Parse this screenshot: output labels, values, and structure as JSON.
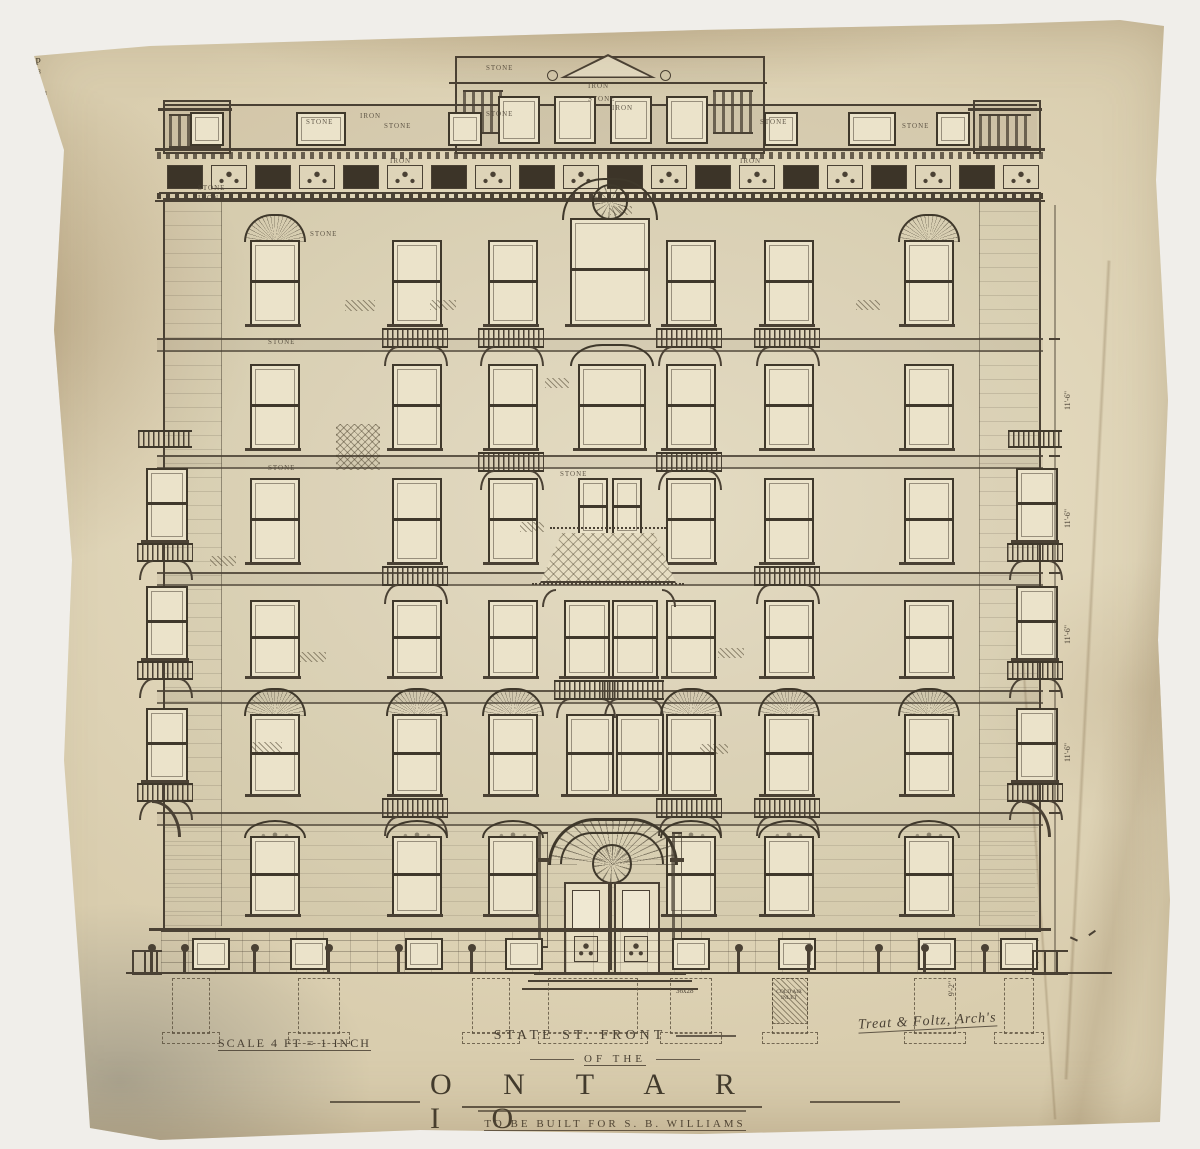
{
  "title_block": {
    "line1": "STATE ST. FRONT",
    "line2": "OF THE",
    "building_name": "O N T A R I O",
    "commission": "TO BE BUILT FOR   S. B. WILLIAMS",
    "date": "1880",
    "scale_note": "SCALE 4 FT = 1 INCH",
    "architect": "Treat & Foltz, Arch's"
  },
  "facade": {
    "ink": "#4a4134",
    "material_labels": [
      {
        "t": "STONE",
        "x": 486,
        "y": 64
      },
      {
        "t": "IRON",
        "x": 588,
        "y": 82
      },
      {
        "t": "STONE",
        "x": 588,
        "y": 95
      },
      {
        "t": "STONE",
        "x": 486,
        "y": 110
      },
      {
        "t": "STONE",
        "x": 306,
        "y": 118
      },
      {
        "t": "IRON",
        "x": 360,
        "y": 112
      },
      {
        "t": "STONE",
        "x": 384,
        "y": 122
      },
      {
        "t": "STONE",
        "x": 198,
        "y": 184
      },
      {
        "t": "IRON",
        "x": 198,
        "y": 194
      },
      {
        "t": "IRON",
        "x": 612,
        "y": 104
      },
      {
        "t": "STONE",
        "x": 760,
        "y": 118
      },
      {
        "t": "STONE",
        "x": 902,
        "y": 122
      },
      {
        "t": "STONE",
        "x": 310,
        "y": 230
      },
      {
        "t": "STONE",
        "x": 268,
        "y": 338
      },
      {
        "t": "STONE",
        "x": 268,
        "y": 464
      },
      {
        "t": "STONE",
        "x": 560,
        "y": 470
      },
      {
        "t": "IRON",
        "x": 740,
        "y": 157
      },
      {
        "t": "IRON",
        "x": 390,
        "y": 157
      }
    ],
    "parapet": {
      "x": 455,
      "y": 56,
      "w": 306,
      "h": 94,
      "windows": [
        {
          "x": 498,
          "mk": "D.T.",
          "db": "36x20"
        },
        {
          "x": 554,
          "mk": "D.T.",
          "db": "18x20"
        },
        {
          "x": 610,
          "mk": "D.T.",
          "db": "18x20"
        },
        {
          "x": 666,
          "mk": "D.T.",
          "db": "36x20"
        }
      ]
    },
    "attic_windows": [
      {
        "x": 190,
        "w": 30,
        "db": "36x16"
      },
      {
        "x": 296,
        "w": 46,
        "db": "32x16 D.T."
      },
      {
        "x": 448,
        "w": 30,
        "db": "26x16"
      },
      {
        "x": 764,
        "w": 30,
        "db": "30x16"
      },
      {
        "x": 848,
        "w": 44,
        "db": "D.T."
      },
      {
        "x": 936,
        "w": 30,
        "db": "32x16"
      }
    ],
    "belts": [
      338,
      455,
      572,
      690,
      812
    ],
    "rows": [
      {
        "y": 240,
        "h": 82,
        "windows": [
          {
            "x": 250,
            "w": 46,
            "hood": "arch",
            "dt": "36x32",
            "mk": "P",
            "db": "36x32"
          },
          {
            "x": 392,
            "w": 46,
            "dt": "36x28",
            "mk": "P",
            "db": "36x28",
            "bal": true
          },
          {
            "x": 488,
            "w": 46,
            "dt": "36x32",
            "mk": "P",
            "db": "36x32",
            "bal": true
          },
          {
            "x": 570,
            "w": 76,
            "y": 218,
            "h": 104,
            "hood": "trac",
            "dt": "",
            "mk": "P",
            "db": "18+24"
          },
          {
            "x": 666,
            "w": 46,
            "dt": "46x28",
            "mk": "P",
            "db": "40x28",
            "bal": true
          },
          {
            "x": 764,
            "w": 46,
            "dt": "40x28",
            "mk": "P",
            "db": "40x28",
            "bal": true
          },
          {
            "x": 904,
            "w": 46,
            "hood": "arch",
            "dt": "32x28",
            "mk": "P",
            "db": "32x28"
          }
        ]
      },
      {
        "y": 364,
        "h": 82,
        "windows": [
          {
            "x": 250,
            "w": 46,
            "dt": "33x38",
            "mk": "P",
            "db": "33x38"
          },
          {
            "x": 392,
            "w": 46,
            "dt": "40x38",
            "mk": "P",
            "db": "40x38"
          },
          {
            "x": 488,
            "w": 46,
            "dt": "40x38",
            "mk": "P",
            "db": "40x38",
            "bal": true
          },
          {
            "x": 578,
            "w": 64,
            "hood": "ogee",
            "dt": "44x38",
            "mk": "P",
            "db": "44x38"
          },
          {
            "x": 666,
            "w": 46,
            "dt": "36x38",
            "mk": "P",
            "db": "36x38",
            "bal": true
          },
          {
            "x": 764,
            "w": 46,
            "dt": "40x38",
            "mk": "P",
            "db": "40x38"
          },
          {
            "x": 904,
            "w": 46,
            "dt": "32x38",
            "mk": "P",
            "db": "32x38"
          }
        ]
      },
      {
        "y": 478,
        "h": 82,
        "windows": [
          {
            "x": 250,
            "w": 46,
            "dt": "32x42",
            "mk": "P",
            "db": "32x42"
          },
          {
            "x": 392,
            "w": 46,
            "dt": "40x42",
            "mk": "P",
            "db": "40x42",
            "bal": true
          },
          {
            "x": 488,
            "w": 46,
            "dt": "40x42",
            "mk": "P",
            "db": "40x42"
          },
          {
            "x": 578,
            "w": 26,
            "h": 54,
            "dt": "18+26",
            "mk": "",
            "db": ""
          },
          {
            "x": 612,
            "w": 26,
            "h": 54,
            "dt": "16+26",
            "mk": "",
            "db": ""
          },
          {
            "x": 666,
            "w": 46,
            "dt": "36x42",
            "mk": "P",
            "db": "36x42"
          },
          {
            "x": 764,
            "w": 46,
            "dt": "40x42",
            "mk": "P",
            "db": "40x42",
            "bal": true
          },
          {
            "x": 904,
            "w": 46,
            "dt": "32x42",
            "mk": "P",
            "db": "32x42"
          }
        ]
      },
      {
        "y": 600,
        "h": 74,
        "windows": [
          {
            "x": 250,
            "w": 46,
            "dt": "36x42",
            "mk": "P",
            "db": "33x42"
          },
          {
            "x": 392,
            "w": 46,
            "dt": "40x42",
            "mk": "P",
            "db": "40x42"
          },
          {
            "x": 488,
            "w": 46,
            "dt": "36x42",
            "mk": "P",
            "db": "36x42"
          },
          {
            "x": 564,
            "w": 42,
            "dt": "22x42",
            "mk": "P",
            "db": "",
            "bal": true
          },
          {
            "x": 612,
            "w": 42,
            "dt": "22x42",
            "mk": "P",
            "db": "",
            "bal": true
          },
          {
            "x": 666,
            "w": 46,
            "dt": "36x42",
            "mk": "P",
            "db": "36x42"
          },
          {
            "x": 764,
            "w": 46,
            "dt": "40x42",
            "mk": "P",
            "db": "40x42"
          },
          {
            "x": 904,
            "w": 46,
            "dt": "32x42",
            "mk": "P",
            "db": "32x42"
          }
        ]
      },
      {
        "y": 714,
        "h": 78,
        "windows": [
          {
            "x": 250,
            "w": 46,
            "hood": "arch2",
            "dt": "36x46",
            "mk": "P",
            "db": "36x46"
          },
          {
            "x": 392,
            "w": 46,
            "hood": "arch2",
            "dt": "40x46",
            "mk": "P",
            "db": "40x46",
            "bal": true
          },
          {
            "x": 488,
            "w": 46,
            "hood": "arch2",
            "dt": "40x46",
            "mk": "P",
            "db": "40x46"
          },
          {
            "x": 566,
            "w": 44,
            "nt": "ONYX MARBLE",
            "dt": "32x32",
            "mk": "P",
            "db": "32x58"
          },
          {
            "x": 616,
            "w": 44,
            "nt": "STAINED",
            "dt": "32x32",
            "mk": "",
            "db": "32x58"
          },
          {
            "x": 666,
            "w": 46,
            "hood": "arch2",
            "dt": "40x46",
            "mk": "P",
            "db": "40x46",
            "bal": true
          },
          {
            "x": 764,
            "w": 46,
            "hood": "arch2",
            "dt": "40x46",
            "mk": "P",
            "db": "40x46",
            "bal": true
          },
          {
            "x": 904,
            "w": 46,
            "hood": "arch2",
            "dt": "32x46",
            "mk": "P",
            "db": "32x46"
          }
        ]
      },
      {
        "y": 836,
        "h": 76,
        "windows": [
          {
            "x": 250,
            "w": 46,
            "hood": "seg",
            "dt": "40x62",
            "mk": "P",
            "db": "40x62"
          },
          {
            "x": 392,
            "w": 46,
            "hood": "seg",
            "dt": "40x62",
            "mk": "P",
            "db": "40x62"
          },
          {
            "x": 488,
            "w": 46,
            "hood": "seg",
            "dt": "44x62",
            "mk": "P",
            "db": "44x62"
          },
          {
            "x": 666,
            "w": 46,
            "hood": "seg",
            "dt": "48 40",
            "mk": "P",
            "db": "40x62"
          },
          {
            "x": 764,
            "w": 46,
            "hood": "seg",
            "dt": "40x62",
            "mk": "P",
            "db": "40x62"
          },
          {
            "x": 904,
            "w": 46,
            "hood": "seg",
            "dt": "36x62",
            "mk": "P",
            "db": "36x62"
          }
        ]
      }
    ],
    "oriels": {
      "xs": [
        146,
        1016
      ],
      "canopy_y": 430,
      "floors": [
        468,
        586,
        708
      ],
      "w": 38,
      "h": 70,
      "mk": "P"
    },
    "canopy": {
      "x": 540,
      "y": 533,
      "w": 136,
      "h": 48
    },
    "basement": {
      "y": 930,
      "h": 42,
      "windows": [
        {
          "x": 192,
          "l1": "D.T.",
          "l2": "30x30"
        },
        {
          "x": 290,
          "l1": "D.T.",
          "l2": "34x30"
        },
        {
          "x": 405,
          "l1": "D.T.",
          "l2": "30x30"
        },
        {
          "x": 505,
          "l1": "D.T.",
          "l2": "36x28"
        },
        {
          "x": 672,
          "l1": "D.T.",
          "l2": "36x28"
        },
        {
          "x": 778,
          "l1": "D.T.",
          "l2": "30x28"
        },
        {
          "x": 918,
          "l1": "D.T.",
          "l2": "36x28"
        },
        {
          "x": 1000,
          "l1": "D.T.",
          "l2": "30x28"
        }
      ],
      "foundations": [
        {
          "x": 172,
          "w": 36
        },
        {
          "x": 298,
          "w": 40
        },
        {
          "x": 472,
          "w": 36
        },
        {
          "x": 548,
          "w": 88
        },
        {
          "x": 670,
          "w": 40
        },
        {
          "x": 772,
          "w": 34
        },
        {
          "x": 914,
          "w": 40
        },
        {
          "x": 1004,
          "w": 28
        }
      ],
      "foundation_note": "36x28",
      "cold_air_label": "COLD AIR INLET"
    },
    "bollards": [
      150,
      183,
      253,
      327,
      397,
      470,
      737,
      807,
      877,
      923,
      983
    ],
    "dims": {
      "side": "11'-6\"",
      "side_ys": [
        396,
        514,
        630,
        748
      ],
      "bottom": "9'-2\""
    },
    "hatches": [
      {
        "x": 345,
        "y": 300,
        "w": 30,
        "h": 11
      },
      {
        "x": 430,
        "y": 300,
        "w": 26,
        "h": 10
      },
      {
        "x": 545,
        "y": 378,
        "w": 24,
        "h": 10
      },
      {
        "x": 336,
        "y": 424,
        "w": 44,
        "h": 46,
        "cross": true
      },
      {
        "x": 520,
        "y": 522,
        "w": 24,
        "h": 10
      },
      {
        "x": 300,
        "y": 652,
        "w": 26,
        "h": 10
      },
      {
        "x": 252,
        "y": 742,
        "w": 30,
        "h": 11
      },
      {
        "x": 700,
        "y": 744,
        "w": 28,
        "h": 10
      },
      {
        "x": 856,
        "y": 300,
        "w": 24,
        "h": 10
      },
      {
        "x": 718,
        "y": 648,
        "w": 26,
        "h": 10
      },
      {
        "x": 210,
        "y": 556,
        "w": 26,
        "h": 10
      },
      {
        "x": 610,
        "y": 206,
        "w": 22,
        "h": 9
      }
    ]
  }
}
